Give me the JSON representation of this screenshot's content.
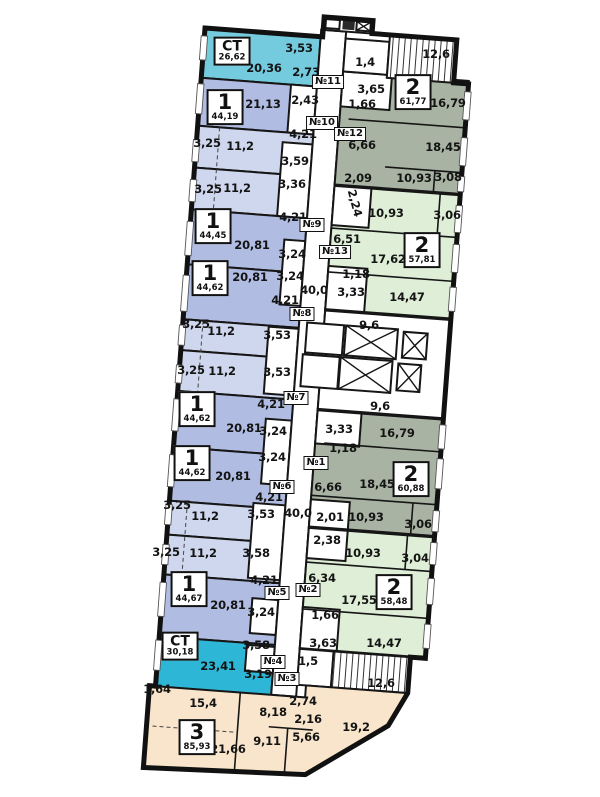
{
  "floor_plan": {
    "colors": {
      "studio_top": "#74cbde",
      "studio_bottom": "#2eb6d6",
      "one_room_main": "#b0bce1",
      "one_room_light": "#cfd7ee",
      "two_room_sage": "#a9b3a3",
      "two_room_green": "#dfeed7",
      "three_room_beige": "#f8e5cb",
      "walls": "#161616",
      "corridor": "#ffffff"
    },
    "apartments": [
      {
        "type": "СТ",
        "area": "26,62",
        "x": 232,
        "y": 51
      },
      {
        "type": "1",
        "area": "44,19",
        "x": 225,
        "y": 107
      },
      {
        "type": "1",
        "area": "44,45",
        "x": 213,
        "y": 226
      },
      {
        "type": "1",
        "area": "44,62",
        "x": 210,
        "y": 278
      },
      {
        "type": "1",
        "area": "44,62",
        "x": 197,
        "y": 409
      },
      {
        "type": "1",
        "area": "44,62",
        "x": 192,
        "y": 463
      },
      {
        "type": "1",
        "area": "44,67",
        "x": 189,
        "y": 589
      },
      {
        "type": "СТ",
        "area": "30,18",
        "x": 180,
        "y": 646
      },
      {
        "type": "3",
        "area": "85,93",
        "x": 197,
        "y": 737
      },
      {
        "type": "2",
        "area": "61,77",
        "x": 413,
        "y": 92
      },
      {
        "type": "2",
        "area": "57,81",
        "x": 422,
        "y": 250
      },
      {
        "type": "2",
        "area": "60,88",
        "x": 411,
        "y": 479
      },
      {
        "type": "2",
        "area": "58,48",
        "x": 394,
        "y": 592
      }
    ],
    "unit_numbers": [
      {
        "t": "№11",
        "x": 328,
        "y": 82
      },
      {
        "t": "№10",
        "x": 322,
        "y": 123
      },
      {
        "t": "№12",
        "x": 350,
        "y": 134
      },
      {
        "t": "№9",
        "x": 312,
        "y": 225
      },
      {
        "t": "№13",
        "x": 335,
        "y": 252
      },
      {
        "t": "№8",
        "x": 302,
        "y": 314
      },
      {
        "t": "№7",
        "x": 296,
        "y": 398
      },
      {
        "t": "№1",
        "x": 316,
        "y": 463
      },
      {
        "t": "№6",
        "x": 282,
        "y": 487
      },
      {
        "t": "№2",
        "x": 308,
        "y": 590
      },
      {
        "t": "№5",
        "x": 277,
        "y": 593
      },
      {
        "t": "№4",
        "x": 273,
        "y": 662
      },
      {
        "t": "№3",
        "x": 287,
        "y": 679
      }
    ],
    "dimensions": [
      {
        "t": "3,53",
        "x": 299,
        "y": 48
      },
      {
        "t": "20,36",
        "x": 264,
        "y": 68
      },
      {
        "t": "2,73",
        "x": 306,
        "y": 72
      },
      {
        "t": "1,4",
        "x": 365,
        "y": 62
      },
      {
        "t": "12,6",
        "x": 436,
        "y": 54
      },
      {
        "t": "3,65",
        "x": 371,
        "y": 89
      },
      {
        "t": "1,66",
        "x": 362,
        "y": 104
      },
      {
        "t": "16,79",
        "x": 448,
        "y": 103
      },
      {
        "t": "21,13",
        "x": 263,
        "y": 104
      },
      {
        "t": "2,43",
        "x": 305,
        "y": 100
      },
      {
        "t": "4,21",
        "x": 303,
        "y": 134
      },
      {
        "t": "6,66",
        "x": 362,
        "y": 145
      },
      {
        "t": "11,2",
        "x": 240,
        "y": 146
      },
      {
        "t": "3,25",
        "x": 207,
        "y": 143
      },
      {
        "t": "18,45",
        "x": 443,
        "y": 147
      },
      {
        "t": "3,59",
        "x": 295,
        "y": 161
      },
      {
        "t": "2,09",
        "x": 358,
        "y": 178
      },
      {
        "t": "10,93",
        "x": 414,
        "y": 178
      },
      {
        "t": "3,08",
        "x": 448,
        "y": 177
      },
      {
        "t": "3,25",
        "x": 208,
        "y": 189
      },
      {
        "t": "11,2",
        "x": 237,
        "y": 188
      },
      {
        "t": "3,36",
        "x": 292,
        "y": 184
      },
      {
        "t": "2,24",
        "x": 355,
        "y": 203,
        "r": 75
      },
      {
        "t": "10,93",
        "x": 386,
        "y": 213
      },
      {
        "t": "3,06",
        "x": 447,
        "y": 215
      },
      {
        "t": "4,21",
        "x": 293,
        "y": 217
      },
      {
        "t": "6,51",
        "x": 347,
        "y": 239
      },
      {
        "t": "20,81",
        "x": 252,
        "y": 245
      },
      {
        "t": "3,24",
        "x": 292,
        "y": 254
      },
      {
        "t": "17,62",
        "x": 388,
        "y": 259
      },
      {
        "t": "20,81",
        "x": 250,
        "y": 277
      },
      {
        "t": "3,24",
        "x": 290,
        "y": 276
      },
      {
        "t": "40,0",
        "x": 314,
        "y": 290
      },
      {
        "t": "4,21",
        "x": 285,
        "y": 300
      },
      {
        "t": "1,18",
        "x": 356,
        "y": 274
      },
      {
        "t": "3,33",
        "x": 351,
        "y": 292
      },
      {
        "t": "14,47",
        "x": 407,
        "y": 297
      },
      {
        "t": "9,6",
        "x": 369,
        "y": 325
      },
      {
        "t": "3,25",
        "x": 196,
        "y": 324
      },
      {
        "t": "11,2",
        "x": 221,
        "y": 331
      },
      {
        "t": "3,53",
        "x": 277,
        "y": 335
      },
      {
        "t": "3,25",
        "x": 191,
        "y": 370
      },
      {
        "t": "11,2",
        "x": 222,
        "y": 371
      },
      {
        "t": "3,53",
        "x": 277,
        "y": 372
      },
      {
        "t": "4,21",
        "x": 271,
        "y": 404
      },
      {
        "t": "20,81",
        "x": 244,
        "y": 428
      },
      {
        "t": "3,24",
        "x": 273,
        "y": 431
      },
      {
        "t": "9,6",
        "x": 380,
        "y": 406
      },
      {
        "t": "3,33",
        "x": 339,
        "y": 429
      },
      {
        "t": "16,79",
        "x": 397,
        "y": 433
      },
      {
        "t": "1,18",
        "x": 343,
        "y": 448
      },
      {
        "t": "18,45",
        "x": 377,
        "y": 484
      },
      {
        "t": "6,66",
        "x": 328,
        "y": 487
      },
      {
        "t": "20,81",
        "x": 233,
        "y": 476
      },
      {
        "t": "3,24",
        "x": 272,
        "y": 457
      },
      {
        "t": "4,21",
        "x": 269,
        "y": 497
      },
      {
        "t": "3,53",
        "x": 261,
        "y": 514
      },
      {
        "t": "40,0",
        "x": 298,
        "y": 513
      },
      {
        "t": "2,01",
        "x": 330,
        "y": 517
      },
      {
        "t": "10,93",
        "x": 366,
        "y": 517
      },
      {
        "t": "3,06",
        "x": 418,
        "y": 524
      },
      {
        "t": "3,25",
        "x": 177,
        "y": 505
      },
      {
        "t": "11,2",
        "x": 205,
        "y": 516
      },
      {
        "t": "2,38",
        "x": 327,
        "y": 540
      },
      {
        "t": "10,93",
        "x": 363,
        "y": 553
      },
      {
        "t": "3,04",
        "x": 415,
        "y": 558
      },
      {
        "t": "3,25",
        "x": 166,
        "y": 552
      },
      {
        "t": "11,2",
        "x": 203,
        "y": 553
      },
      {
        "t": "3,58",
        "x": 256,
        "y": 553
      },
      {
        "t": "6,34",
        "x": 322,
        "y": 578
      },
      {
        "t": "17,55",
        "x": 359,
        "y": 600
      },
      {
        "t": "1,66",
        "x": 325,
        "y": 615
      },
      {
        "t": "20,81",
        "x": 228,
        "y": 605
      },
      {
        "t": "4,21",
        "x": 264,
        "y": 580
      },
      {
        "t": "3,24",
        "x": 261,
        "y": 612
      },
      {
        "t": "3,63",
        "x": 323,
        "y": 643
      },
      {
        "t": "14,47",
        "x": 384,
        "y": 643
      },
      {
        "t": "23,41",
        "x": 218,
        "y": 666
      },
      {
        "t": "3,58",
        "x": 256,
        "y": 645
      },
      {
        "t": "3,19",
        "x": 258,
        "y": 674
      },
      {
        "t": "1,5",
        "x": 308,
        "y": 661
      },
      {
        "t": "12,6",
        "x": 381,
        "y": 683
      },
      {
        "t": "1,64",
        "x": 157,
        "y": 689
      },
      {
        "t": "15,4",
        "x": 203,
        "y": 703
      },
      {
        "t": "8,18",
        "x": 273,
        "y": 712
      },
      {
        "t": "2,74",
        "x": 303,
        "y": 701
      },
      {
        "t": "2,16",
        "x": 308,
        "y": 719
      },
      {
        "t": "19,2",
        "x": 356,
        "y": 727
      },
      {
        "t": "9,11",
        "x": 267,
        "y": 741
      },
      {
        "t": "5,66",
        "x": 306,
        "y": 737
      },
      {
        "t": "21,66",
        "x": 228,
        "y": 749
      }
    ]
  }
}
